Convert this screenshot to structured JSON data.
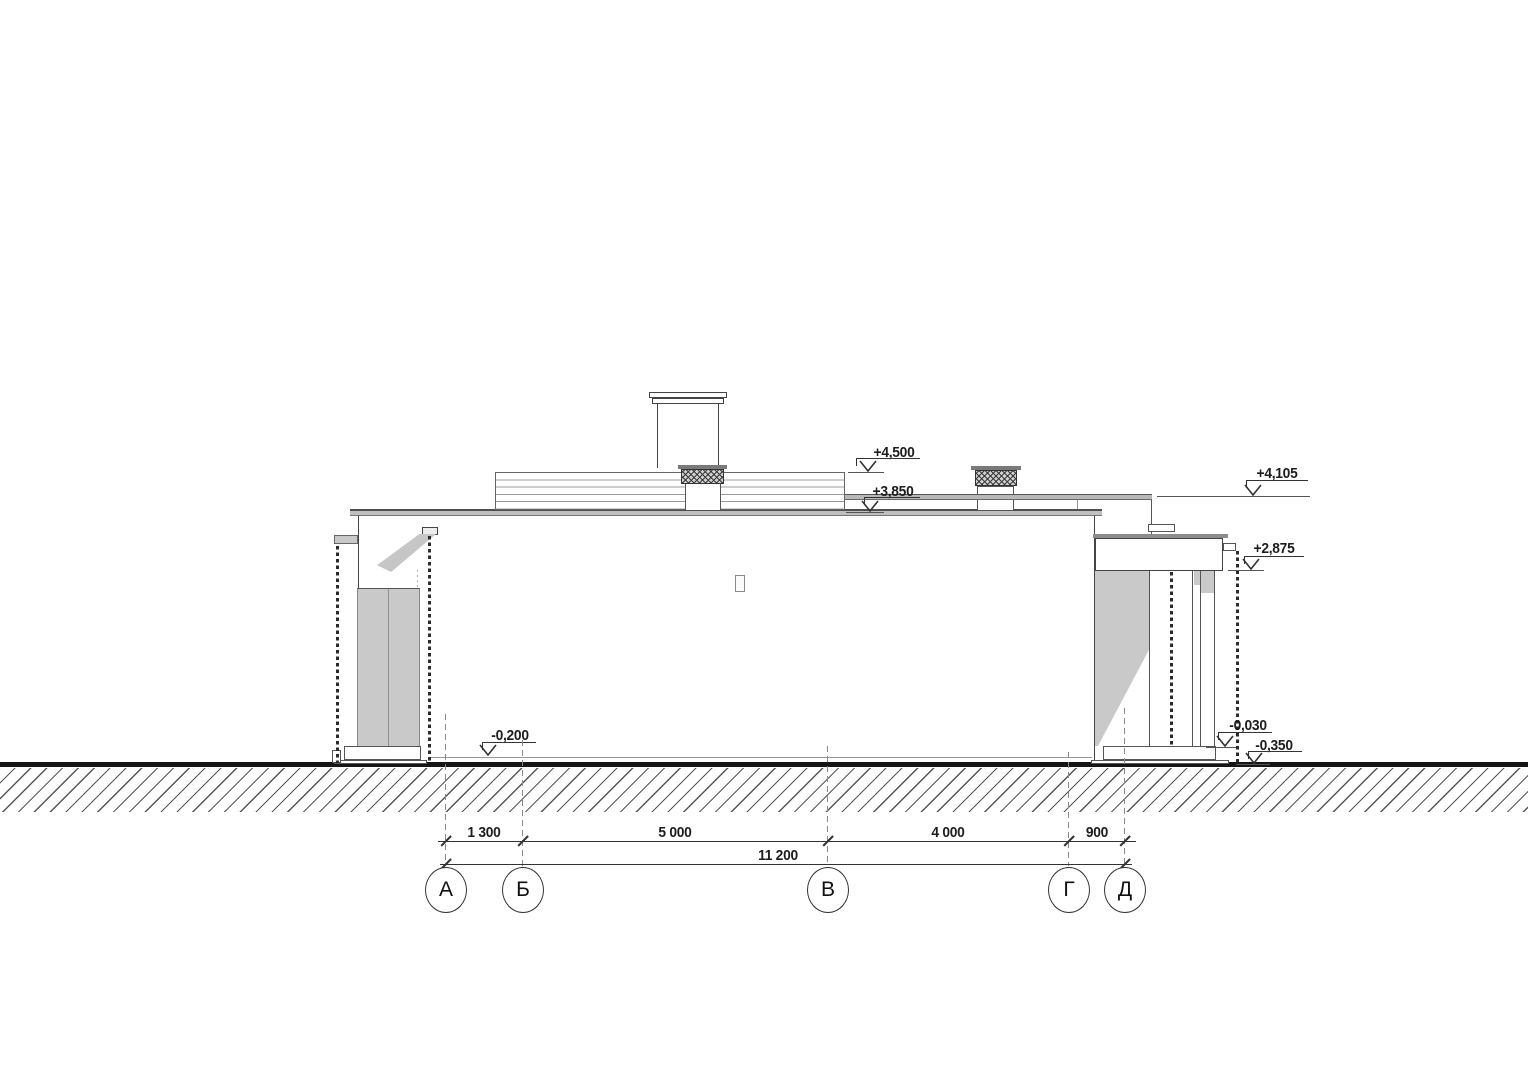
{
  "levels": {
    "l4500": "+4,500",
    "l3850": "+3,850",
    "l4105": "+4,105",
    "l2875": "+2,875",
    "lm030": "-0,030",
    "lm350": "-0,350",
    "lm200": "-0,200"
  },
  "dimensions": {
    "ab": "1 300",
    "bv": "5 000",
    "vg": "4 000",
    "gd": "900",
    "total": "11 200"
  },
  "axes": {
    "a": "А",
    "b": "Б",
    "v": "В",
    "g": "Г",
    "d": "Д"
  },
  "colors": {
    "line": "#333333",
    "ground": "#161616",
    "fill_gray": "#c9c9c9"
  }
}
